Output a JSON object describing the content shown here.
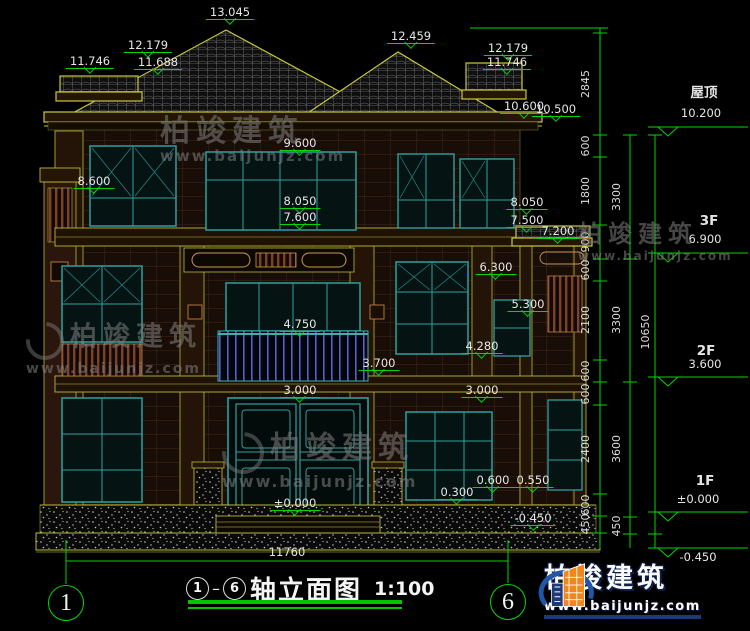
{
  "title": {
    "axis_from": "1",
    "axis_to": "6",
    "text": "轴立面图",
    "scale": "1:100"
  },
  "axes": {
    "left": "1",
    "right": "6"
  },
  "brand": {
    "name": "柏竣建筑",
    "url": "www.baijunjz.com"
  },
  "watermark": {
    "name": "柏竣建筑",
    "url": "www.baijunjz.com"
  },
  "floors": [
    "屋顶",
    "3F",
    "2F",
    "1F"
  ],
  "dimension_chains": {
    "detail": [
      "2845",
      "600",
      "1800",
      "900",
      "600",
      "2100",
      "600",
      "600",
      "2400",
      "600",
      "450"
    ],
    "floor_heights": [
      "3300",
      "3300",
      "3600",
      "450"
    ],
    "total_height": "10650",
    "overall_width": "11760"
  },
  "elevation_marks": [
    "13.045",
    "12.459",
    "12.179",
    "11.746",
    "11.688",
    "10.600",
    "10.500",
    "10.200",
    "9.600",
    "8.600",
    "8.050",
    "7.600",
    "7.500",
    "7.200",
    "6.900",
    "6.300",
    "5.300",
    "4.750",
    "4.280",
    "3.700",
    "3.600",
    "3.000",
    "±0.000",
    "0.600",
    "0.550",
    "0.300",
    "-0.450"
  ],
  "labels": [
    {
      "t": "13.045",
      "x": 230,
      "y": 6,
      "k": "level"
    },
    {
      "t": "12.459",
      "x": 411,
      "y": 30,
      "k": "level"
    },
    {
      "t": "12.179",
      "x": 148,
      "y": 39,
      "k": "level"
    },
    {
      "t": "11.746",
      "x": 90,
      "y": 55,
      "k": "level"
    },
    {
      "t": "11.688",
      "x": 158,
      "y": 56,
      "k": "level"
    },
    {
      "t": "12.179",
      "x": 508,
      "y": 42,
      "k": "level"
    },
    {
      "t": "11.746",
      "x": 507,
      "y": 56,
      "k": "level"
    },
    {
      "t": "10.600",
      "x": 524,
      "y": 100,
      "k": "level"
    },
    {
      "t": "10.500",
      "x": 556,
      "y": 103,
      "k": "level"
    },
    {
      "t": "9.600",
      "x": 300,
      "y": 137,
      "k": "level"
    },
    {
      "t": "8.600",
      "x": 94,
      "y": 175,
      "k": "level"
    },
    {
      "t": "8.050",
      "x": 300,
      "y": 195,
      "k": "level"
    },
    {
      "t": "7.600",
      "x": 300,
      "y": 211,
      "k": "level"
    },
    {
      "t": "8.050",
      "x": 527,
      "y": 196,
      "k": "level"
    },
    {
      "t": "7.500",
      "x": 527,
      "y": 214,
      "k": "level"
    },
    {
      "t": "7.200",
      "x": 558,
      "y": 225,
      "k": "level"
    },
    {
      "t": "6.300",
      "x": 496,
      "y": 261,
      "k": "level"
    },
    {
      "t": "5.300",
      "x": 528,
      "y": 298,
      "k": "level"
    },
    {
      "t": "4.750",
      "x": 300,
      "y": 318,
      "k": "level"
    },
    {
      "t": "3.700",
      "x": 379,
      "y": 357,
      "k": "level"
    },
    {
      "t": "4.280",
      "x": 482,
      "y": 340,
      "k": "level"
    },
    {
      "t": "3.000",
      "x": 300,
      "y": 384,
      "k": "level"
    },
    {
      "t": "3.000",
      "x": 482,
      "y": 384,
      "k": "level"
    },
    {
      "t": "±0.000",
      "x": 295,
      "y": 497,
      "k": "level"
    },
    {
      "t": "0.300",
      "x": 457,
      "y": 486,
      "k": "level"
    },
    {
      "t": "0.600",
      "x": 493,
      "y": 474,
      "k": "level"
    },
    {
      "t": "0.550",
      "x": 533,
      "y": 474,
      "k": "level"
    },
    {
      "t": "-0.450",
      "x": 533,
      "y": 512,
      "k": "level"
    },
    {
      "t": "屋顶",
      "x": 704,
      "y": 86,
      "k": "floor"
    },
    {
      "t": "10.200",
      "x": 701,
      "y": 107,
      "k": "plain"
    },
    {
      "t": "3F",
      "x": 709,
      "y": 214,
      "k": "floor"
    },
    {
      "t": "6.900",
      "x": 705,
      "y": 233,
      "k": "plain"
    },
    {
      "t": "2F",
      "x": 706,
      "y": 344,
      "k": "floor"
    },
    {
      "t": "3.600",
      "x": 705,
      "y": 358,
      "k": "plain"
    },
    {
      "t": "1F",
      "x": 705,
      "y": 474,
      "k": "floor"
    },
    {
      "t": "±0.000",
      "x": 698,
      "y": 493,
      "k": "plain"
    },
    {
      "t": "-0.450",
      "x": 698,
      "y": 551,
      "k": "plain"
    },
    {
      "t": "11760",
      "x": 287,
      "y": 546,
      "k": "plain"
    },
    {
      "t": "2845",
      "x": 586,
      "y": 84,
      "k": "dimv"
    },
    {
      "t": "600",
      "x": 586,
      "y": 146,
      "k": "dimv"
    },
    {
      "t": "1800",
      "x": 586,
      "y": 191,
      "k": "dimv"
    },
    {
      "t": "900",
      "x": 586,
      "y": 242,
      "k": "dimv"
    },
    {
      "t": "600",
      "x": 586,
      "y": 270,
      "k": "dimv"
    },
    {
      "t": "2100",
      "x": 586,
      "y": 320,
      "k": "dimv"
    },
    {
      "t": "600",
      "x": 586,
      "y": 371,
      "k": "dimv"
    },
    {
      "t": "600",
      "x": 586,
      "y": 394,
      "k": "dimv"
    },
    {
      "t": "2400",
      "x": 586,
      "y": 449,
      "k": "dimv"
    },
    {
      "t": "600",
      "x": 586,
      "y": 505,
      "k": "dimv"
    },
    {
      "t": "450",
      "x": 586,
      "y": 524,
      "k": "dimv"
    },
    {
      "t": "3300",
      "x": 617,
      "y": 197,
      "k": "dimv"
    },
    {
      "t": "3300",
      "x": 617,
      "y": 320,
      "k": "dimv"
    },
    {
      "t": "3600",
      "x": 617,
      "y": 449,
      "k": "dimv"
    },
    {
      "t": "450",
      "x": 617,
      "y": 526,
      "k": "dimv"
    },
    {
      "t": "10650",
      "x": 646,
      "y": 332,
      "k": "dimv"
    }
  ],
  "colors": {
    "dim_green": "#00d800",
    "outline_yellow": "#c9c93e",
    "window_teal": "#2fa0a0",
    "text_white": "#e6e6e6",
    "brand_orange": "#f0861c",
    "brand_blue": "#2157a8"
  }
}
